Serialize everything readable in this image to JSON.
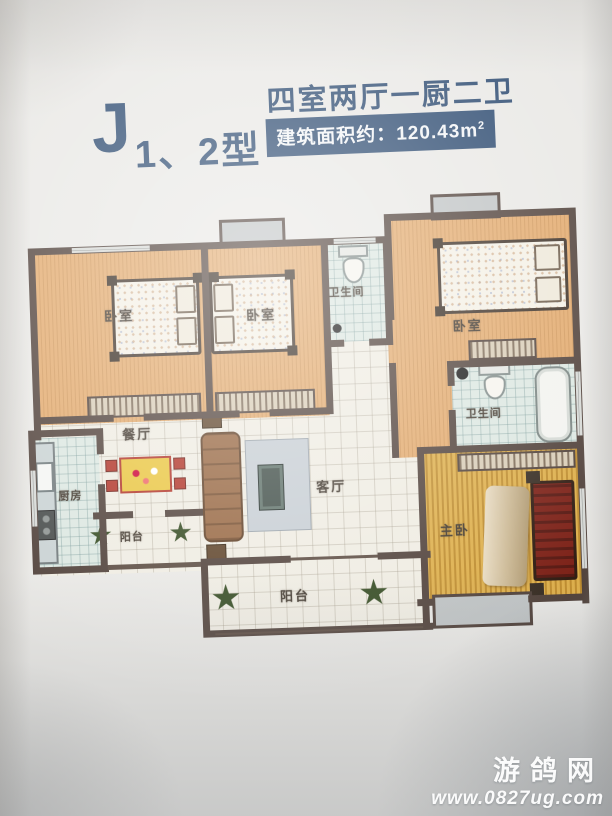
{
  "header": {
    "model_letter": "J",
    "model_suffix": "1、2型",
    "layout_spec": "四室两厅一厨二卫",
    "area_prefix": "建筑面积约：",
    "area_value": "120.43m",
    "area_sup": "2"
  },
  "rooms": {
    "bedroom_left": "卧室",
    "bedroom_mid": "卧室",
    "bedroom_right": "卧室",
    "bathroom_top": "卫生间",
    "bathroom_right": "卫生间",
    "dining": "餐厅",
    "living": "客厅",
    "kitchen": "厨房",
    "master_bedroom": "主卧",
    "balcony_left": "阳台",
    "balcony_bottom": "阳台"
  },
  "watermark": {
    "site_name": "游鸽网",
    "site_url": "www.0827ug.com"
  },
  "colors": {
    "title_navy": "#2c4a70",
    "wall_brown": "#4f4039",
    "bedroom_floor": "#e2a96c",
    "master_floor": "#d6a33e",
    "hall_tile": "#efece2",
    "wet_tile": "#dce7e1",
    "master_bed_red": "#7b1f15",
    "paper": "#e9e8e5"
  }
}
